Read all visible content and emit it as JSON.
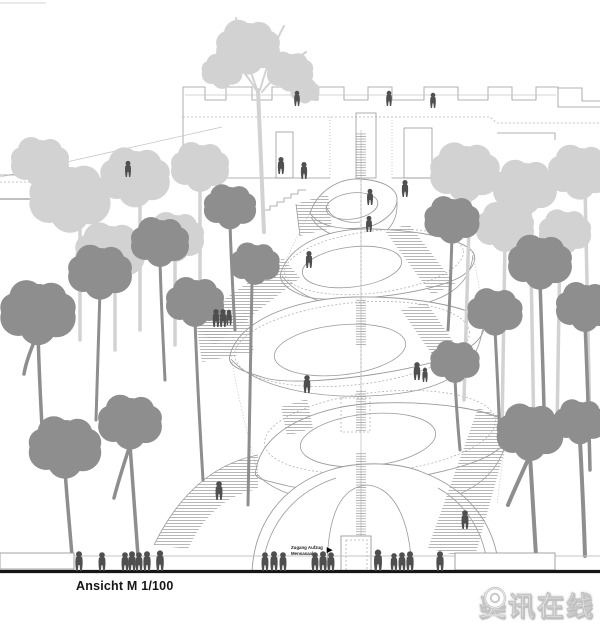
{
  "palette": {
    "bg": "#ffffff",
    "line": "#9a9a9a",
    "tree_light": "#d2d2d2",
    "tree_dark": "#8e8e8e",
    "people": "#4f4f4f",
    "ink": "#161616",
    "wm_stroke": "#c3c3c3"
  },
  "drawing": {
    "caption": "Ansicht M 1/100"
  },
  "annotation": {
    "line1": "Zugang Aufzug",
    "line2": "Mensasaal",
    "arrow": "►"
  },
  "watermark": {
    "text": "美讯在线",
    "icon": "magnifier-icon"
  }
}
